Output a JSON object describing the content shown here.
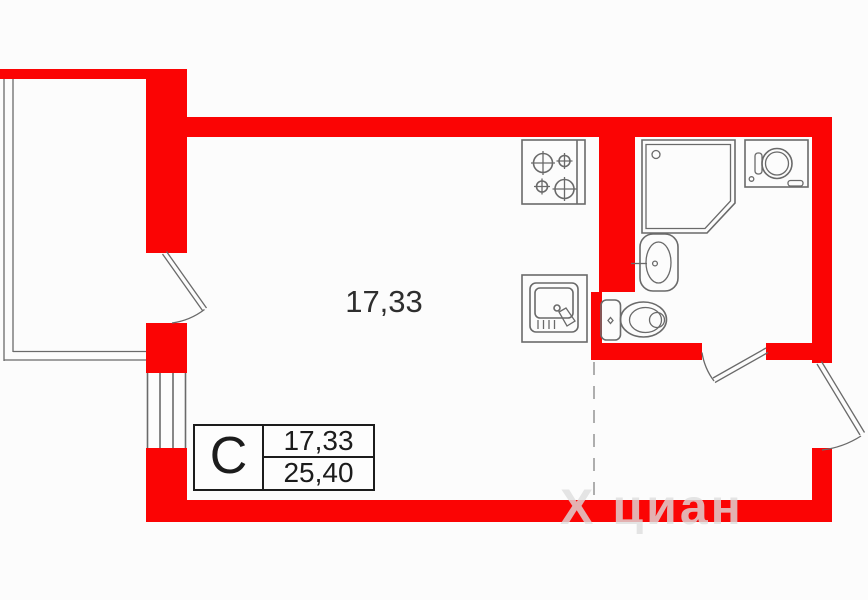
{
  "floor_plan": {
    "room_area": "17,33",
    "legend": {
      "type_letter": "С",
      "living_area": "17,33",
      "total_area": "25,40"
    },
    "watermark": {
      "logo": "Х",
      "brand": "циан"
    }
  },
  "colors": {
    "wall": "#fb0404",
    "outline": "#6a6a6a",
    "text": "#1c1c1c",
    "dashed": "#9a9a9a",
    "watermark": "rgba(221,221,221,0.8)"
  }
}
